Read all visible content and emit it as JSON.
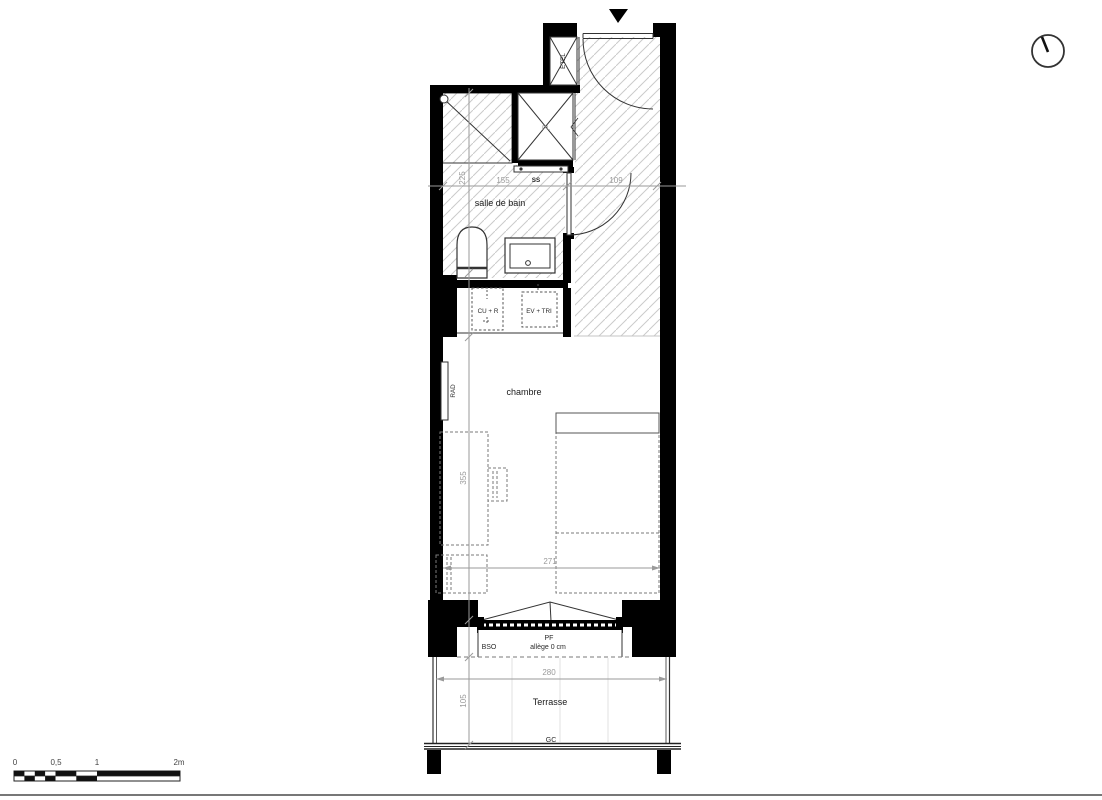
{
  "plan": {
    "rooms": {
      "bathroom": "salle de bain",
      "bedroom": "chambre",
      "terrace": "Terrasse"
    },
    "fixtures": {
      "etel": "ETEL",
      "closet": "PL",
      "towel_rail": "SS",
      "radiator": "RAD",
      "kitchen_unit": "CU + R",
      "sink_unit": "EV + TRI"
    },
    "window": {
      "type": "PF",
      "blind": "BSO",
      "sill": "allège 0 cm"
    },
    "guardrail": "GC",
    "dims": {
      "bath_depth": "225",
      "bath_width": "155",
      "hall_width": "109",
      "room_depth": "355",
      "room_width": "271",
      "terrace_width": "280",
      "terrace_depth": "105"
    }
  },
  "scale_bar": {
    "labels": [
      "0",
      "0,5",
      "1",
      "2m"
    ]
  },
  "icons": {
    "north": "north-arrow-icon",
    "entrance": "entrance-arrow-icon"
  },
  "colors": {
    "wall": "#000000",
    "line": "#333333",
    "hatch": "#cbcbcb",
    "dim": "#9a9a9a",
    "dash": "#7a7a7a",
    "text": "#1a1a1a"
  }
}
